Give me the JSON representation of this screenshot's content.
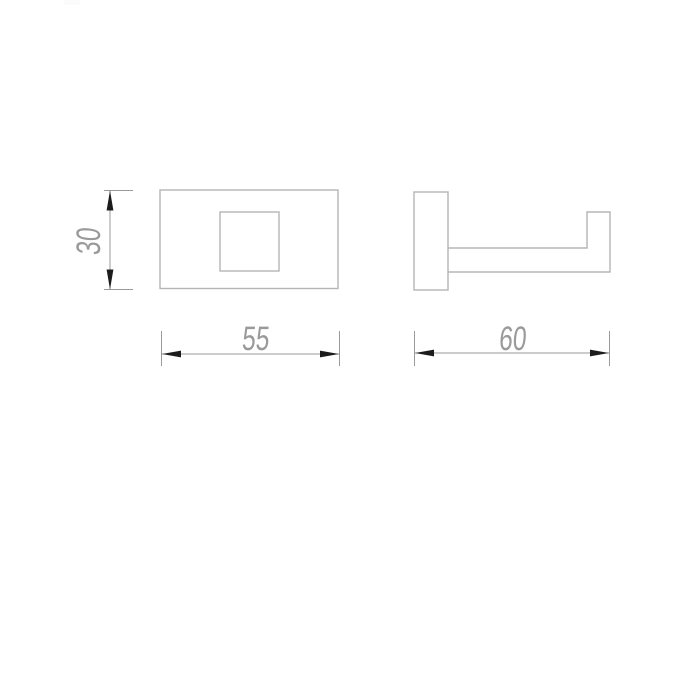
{
  "colors": {
    "background": "#ffffff",
    "outline": "#b5b5b5",
    "dimension": "#9a9a9a",
    "arrow": "#1c1c1c",
    "label": "#9a9a9a",
    "watermark": "#fbfbfb"
  },
  "drawing": {
    "type": "technical-dimension-drawing",
    "views": {
      "front": {
        "name": "front-view"
      },
      "side": {
        "name": "side-view"
      }
    },
    "dimensions": {
      "front_height": "30",
      "front_width": "55",
      "side_depth": "60"
    }
  }
}
